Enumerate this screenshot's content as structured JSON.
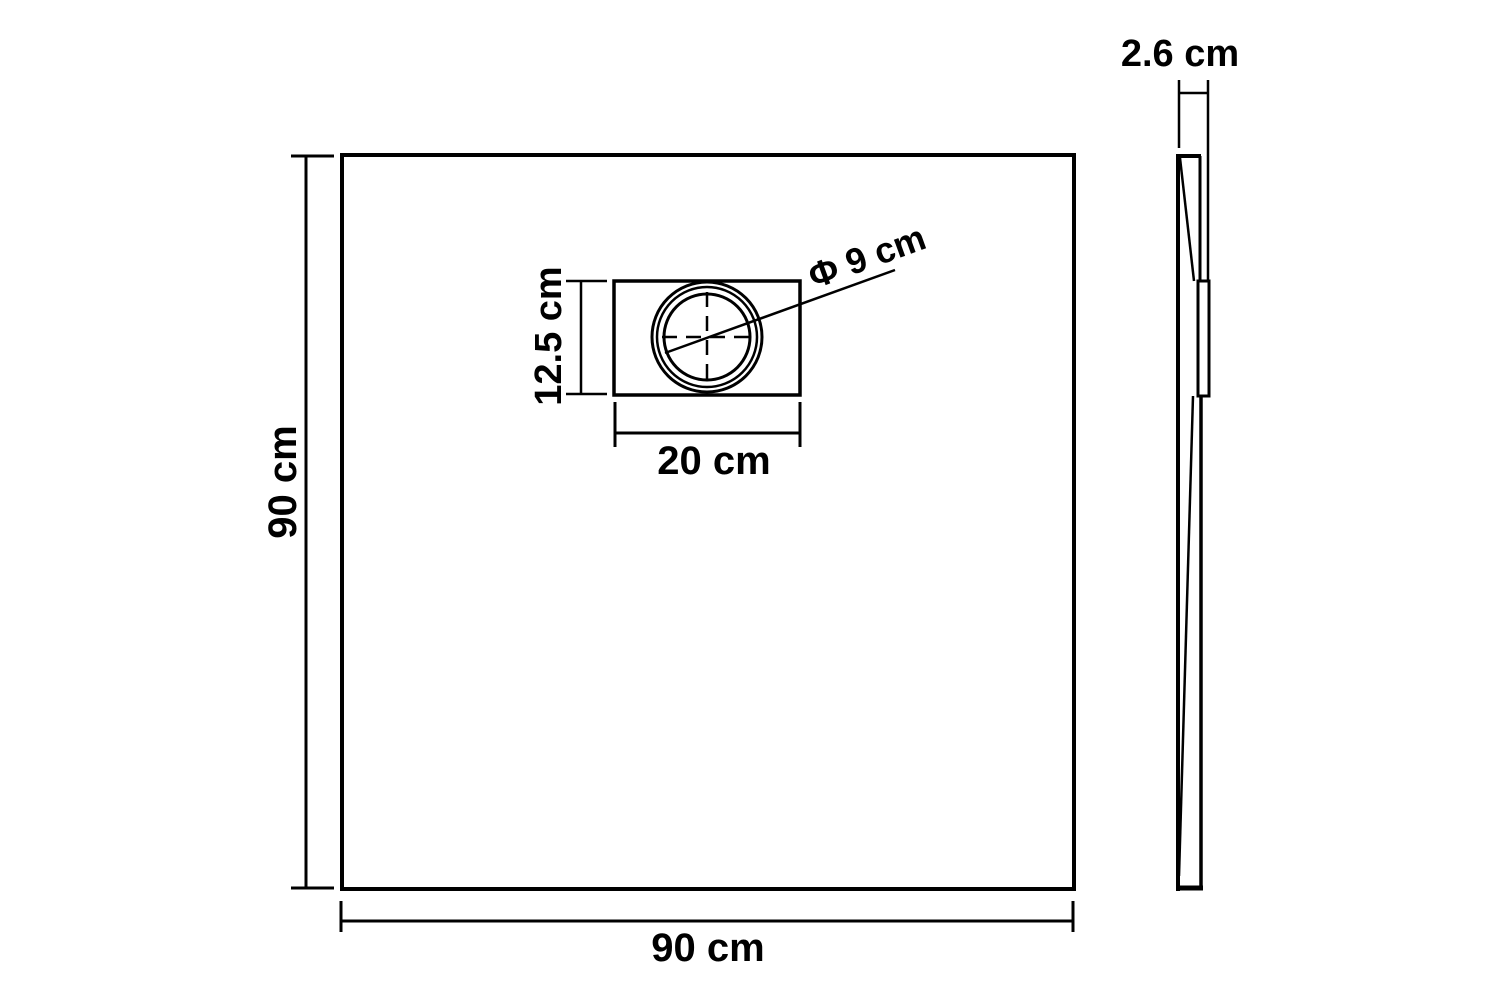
{
  "diagram": {
    "type": "technical-dimension-drawing",
    "subject": "square shower base tray, top view and side profile view",
    "colors": {
      "background": "#ffffff",
      "line": "#000000",
      "text": "#000000"
    },
    "top_view": {
      "height_label": "90 cm",
      "width_label": "90 cm",
      "drain": {
        "plate_width_label": "20 cm",
        "plate_height_label": "12.5 cm",
        "diameter_label": "Φ 9 cm"
      }
    },
    "side_view": {
      "thickness_label": "2.6 cm"
    }
  }
}
